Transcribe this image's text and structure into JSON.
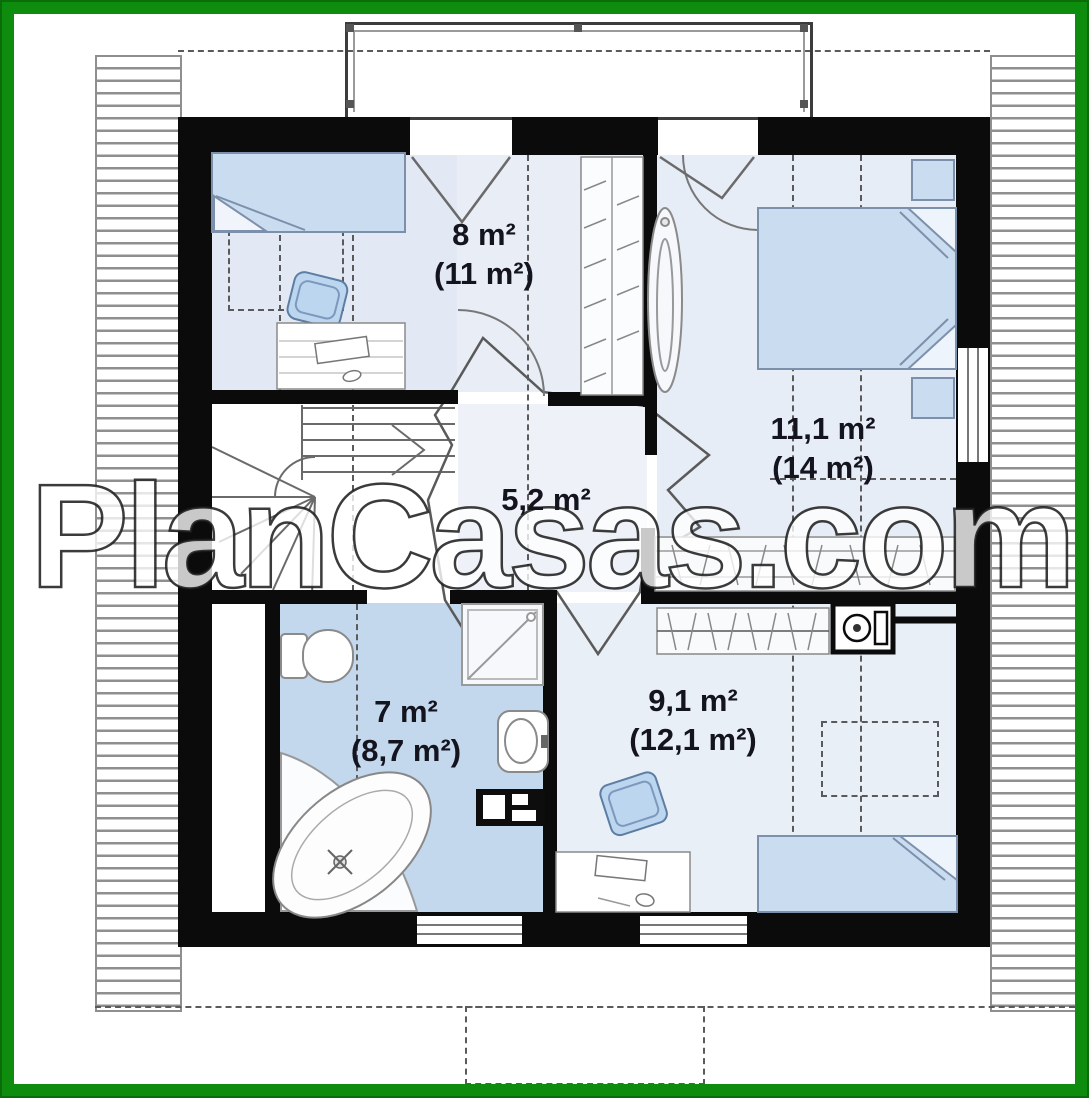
{
  "watermark": {
    "text": "PlanCasas.com"
  },
  "plan": {
    "rooms": [
      {
        "id": "room-8",
        "area": "8 m²",
        "area_total": "(11 m²)"
      },
      {
        "id": "bedroom-11",
        "area": "11,1 m²",
        "area_total": "(14 m²)"
      },
      {
        "id": "hall-5",
        "area": "5,2 m²",
        "area_total": ""
      },
      {
        "id": "bathroom-7",
        "area": "7 m²",
        "area_total": "(8,7 m²)"
      },
      {
        "id": "bedroom-9",
        "area": "9,1 m²",
        "area_total": "(12,1 m²)"
      }
    ]
  },
  "colors": {
    "frame_green": "#0e8c0e",
    "wall_black": "#0b0b0b",
    "bath_floor_blue": "#c3d7ed",
    "room_floor_blue": "#e8edf6",
    "furniture_fill_blue": "#cadcf0",
    "furniture_stroke": "#7d90ab"
  }
}
